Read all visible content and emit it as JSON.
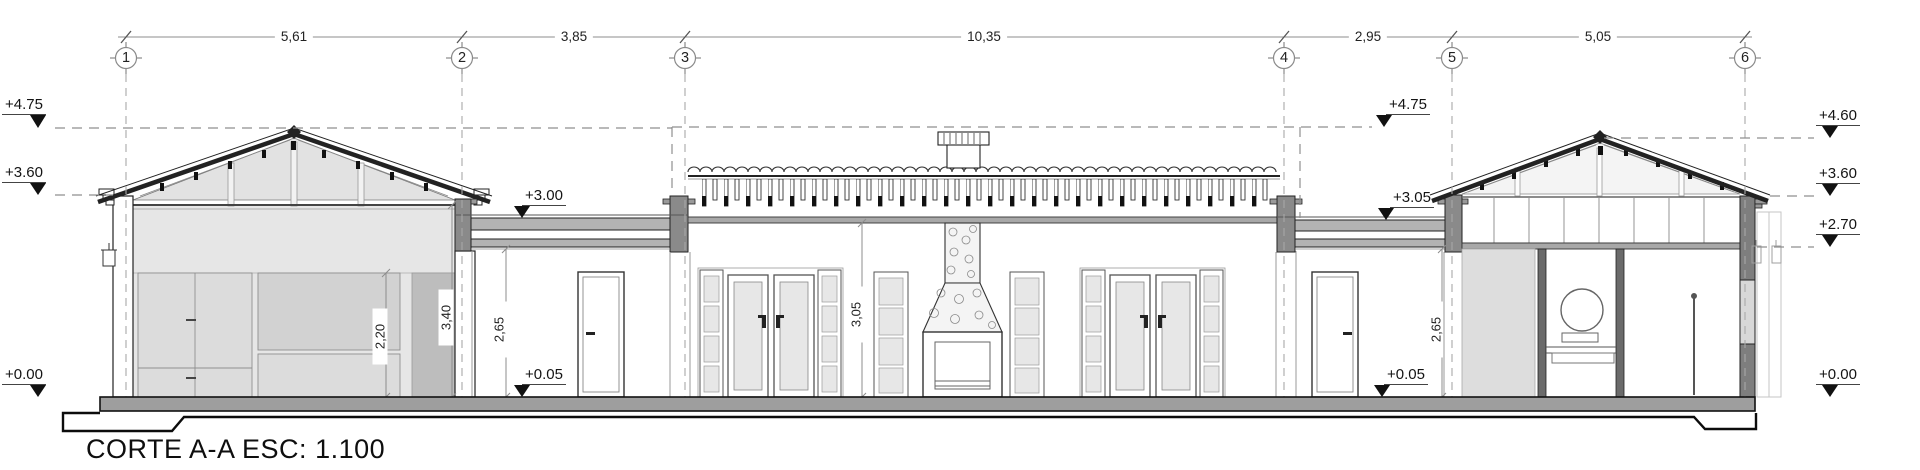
{
  "title": "CORTE A-A ESC: 1.100",
  "grid": {
    "bubbles": [
      {
        "label": "1"
      },
      {
        "label": "2"
      },
      {
        "label": "3"
      },
      {
        "label": "4"
      },
      {
        "label": "5"
      },
      {
        "label": "6"
      }
    ],
    "spans": [
      {
        "label": "5,61"
      },
      {
        "label": "3,85"
      },
      {
        "label": "10,35"
      },
      {
        "label": "2,95"
      },
      {
        "label": "5,05"
      }
    ]
  },
  "levels": {
    "left": [
      {
        "label": "+4.75"
      },
      {
        "label": "+3.60"
      },
      {
        "label": "+0.00"
      }
    ],
    "right": [
      {
        "label": "+4.60"
      },
      {
        "label": "+3.60"
      },
      {
        "label": "+2.70"
      },
      {
        "label": "+0.00"
      }
    ],
    "interior": [
      {
        "label": "+3.00"
      },
      {
        "label": "+0.05"
      },
      {
        "label": "+4.75"
      },
      {
        "label": "+3.05"
      },
      {
        "label": "+0.05"
      }
    ]
  },
  "dims": {
    "vertical": [
      {
        "label": "2,20"
      },
      {
        "label": "3,40"
      },
      {
        "label": "2,65"
      },
      {
        "label": "3,05"
      },
      {
        "label": "2,65"
      }
    ]
  },
  "colors": {
    "line": "#2a2a2a",
    "fill_light": "#e5e5e5",
    "fill_mid": "#b5b5b5",
    "fill_dark": "#8a8a8a",
    "marker": "#111111"
  }
}
